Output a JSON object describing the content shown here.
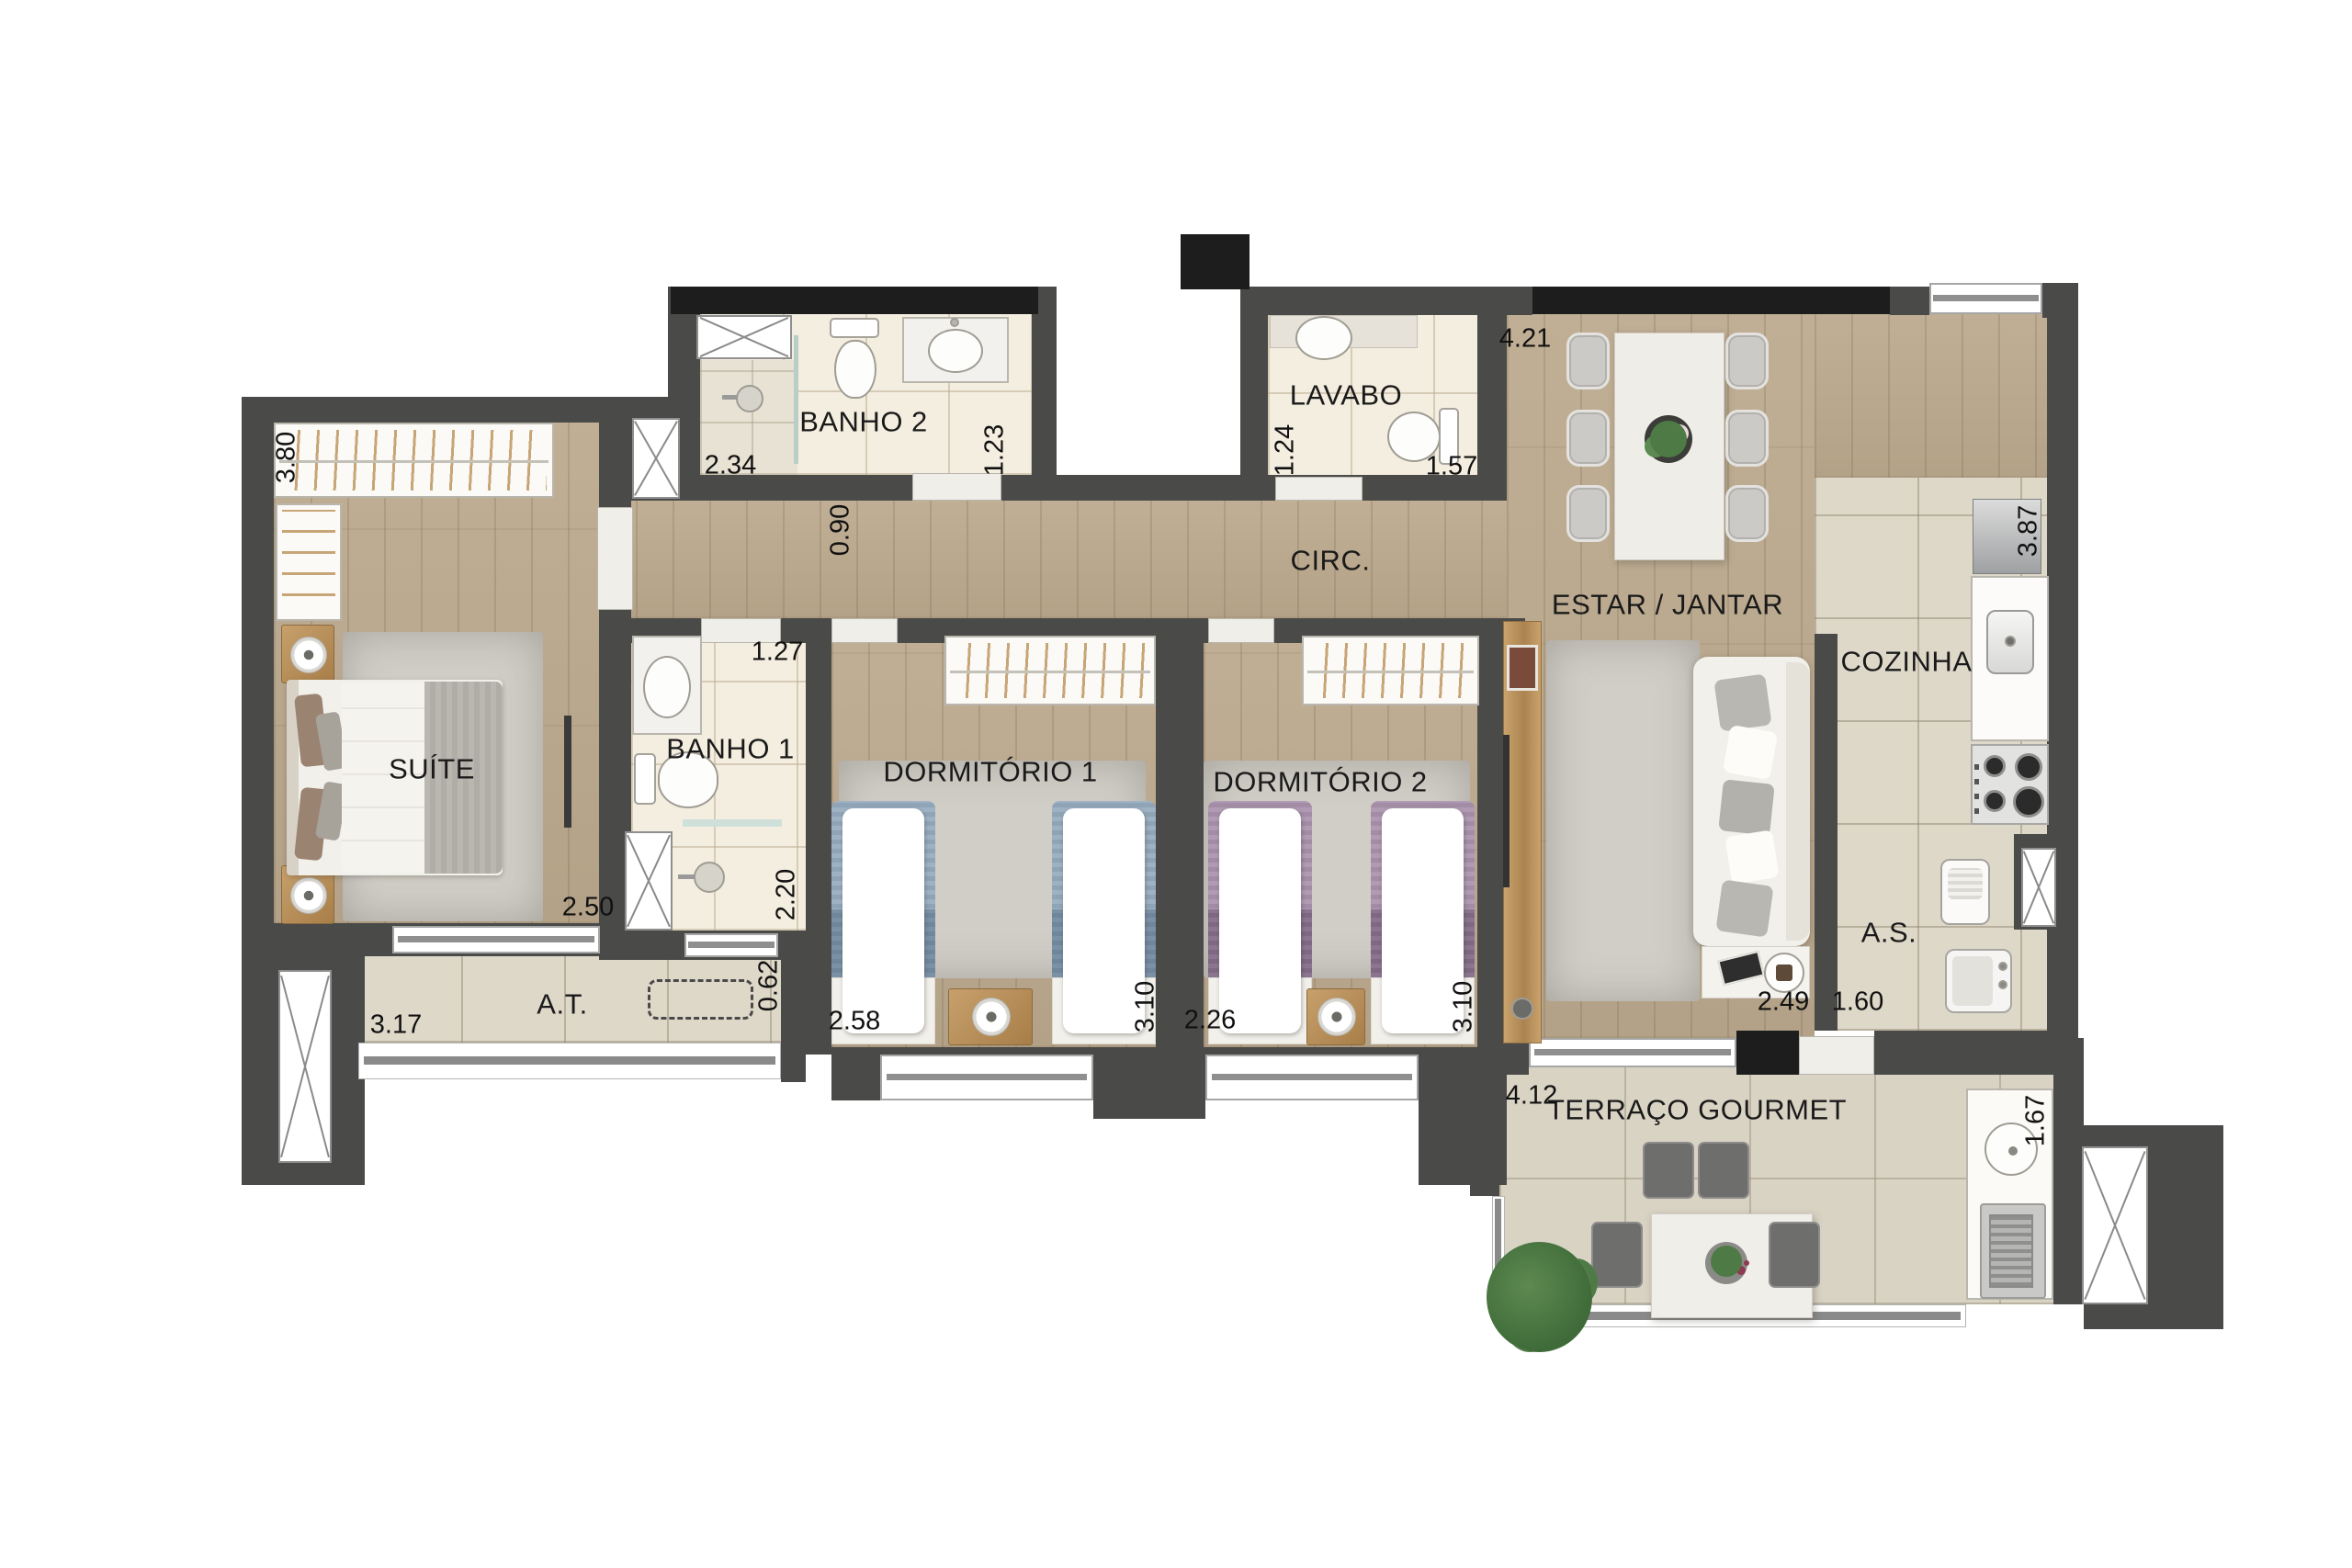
{
  "plan_type": "apartment-floor-plan",
  "language": "pt-BR",
  "rooms": {
    "suite": {
      "label": "SUÍTE",
      "dim_closet": "3.80",
      "dim_width": "2.50"
    },
    "banho1": {
      "label": "BANHO 1",
      "dim_width": "1.27",
      "dim_depth": "2.20"
    },
    "banho2": {
      "label": "BANHO 2",
      "dim_width": "2.34",
      "dim_depth": "1.23"
    },
    "lavabo": {
      "label": "LAVABO",
      "dim_width": "1.24",
      "dim_depth": "1.57"
    },
    "circulacao": {
      "label": "CIRC.",
      "dim_width": "0.90"
    },
    "estar_jantar": {
      "label": "ESTAR / JANTAR",
      "dim_width": "4.21",
      "dim_depth": "2.49"
    },
    "cozinha": {
      "label": "COZINHA",
      "dim_depth": "3.87"
    },
    "area_servico": {
      "label": "A.S.",
      "dim_width": "1.60"
    },
    "area_tecnica": {
      "label": "A.T.",
      "dim_width": "3.17",
      "dim_depth": "0.62"
    },
    "dormitorio1": {
      "label": "DORMITÓRIO 1",
      "dim_width": "2.58",
      "dim_depth": "3.10"
    },
    "dormitorio2": {
      "label": "DORMITÓRIO 2",
      "dim_width": "2.26",
      "dim_depth": "3.10"
    },
    "terraco_gourmet": {
      "label": "TERRAÇO GOURMET",
      "dim_width": "4.12",
      "dim_depth": "1.67"
    }
  },
  "colors": {
    "wall": "#4a4a48",
    "lintel": "#1d1d1d",
    "wood_floor": "#b9a88e",
    "tile_floor": "#ded8c9",
    "bath_floor": "#f4eee0",
    "terrace_floor": "#d9d3c4",
    "bed_blue": "#8fa4b7",
    "bed_purple": "#a28ca6",
    "plant_green": "#4e7b45"
  }
}
